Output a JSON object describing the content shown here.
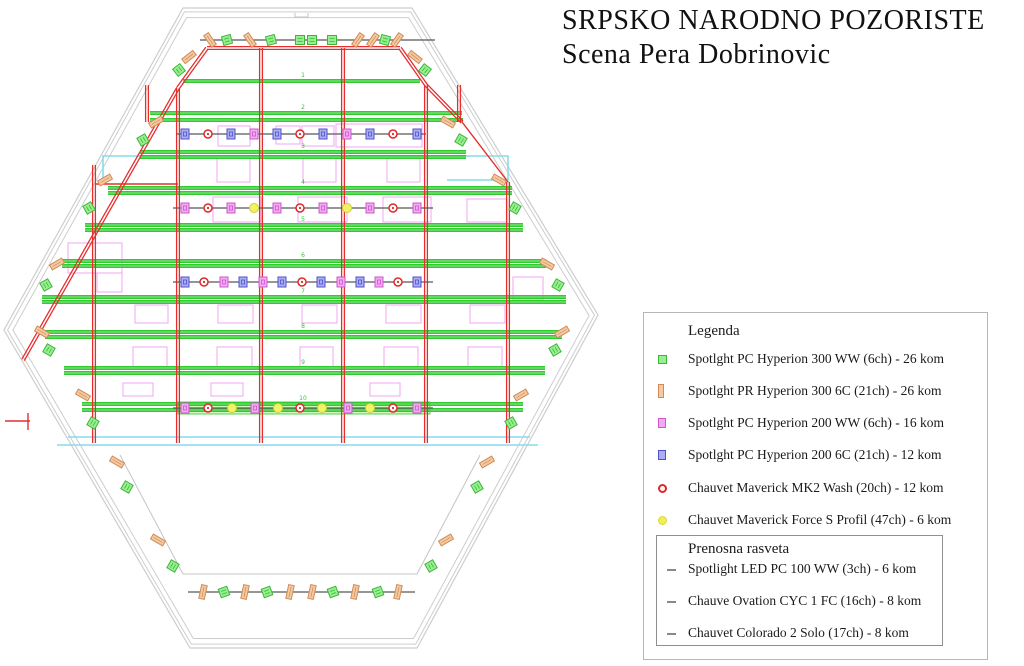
{
  "title": {
    "line1": "SRPSKO NARODNO POZORISTE",
    "line2": "Scena Pera Dobrinovic"
  },
  "legend": {
    "title": "Legenda",
    "items": [
      {
        "icon": "pc-hyperion-300ww-icon",
        "type": "G",
        "label": "Spotlght PC Hyperion 300 WW (6ch) - 26 kom"
      },
      {
        "icon": "pr-hyperion-300-6c-icon",
        "type": "O",
        "label": "Spotlght PR Hyperion 300 6C (21ch) - 26 kom"
      },
      {
        "icon": "pc-hyperion-200ww-icon",
        "type": "M",
        "label": "Spotlght PC Hyperion 200 WW (6ch) - 16 kom"
      },
      {
        "icon": "pc-hyperion-200-6c-icon",
        "type": "B",
        "label": "Spotlght PC Hyperion 200 6C (21ch) - 12 kom"
      },
      {
        "icon": "maverick-mk2-wash-icon",
        "type": "R",
        "label": "Chauvet Maverick MK2 Wash (20ch) - 12 kom"
      },
      {
        "icon": "maverick-force-s-icon",
        "type": "Y",
        "label": "Chauvet Maverick Force S Profil (47ch) - 6 kom"
      }
    ]
  },
  "portable": {
    "title": "Prenosna rasveta",
    "items": [
      {
        "icon": "dash-icon",
        "label": "Spotlight LED PC 100 WW (3ch) - 6 kom"
      },
      {
        "icon": "dash-icon",
        "label": "Chauve Ovation CYC 1 FC (16ch) - 8 kom"
      },
      {
        "icon": "dash-icon",
        "label": "Chauvet Colorado 2 Solo (17ch) - 8 kom"
      }
    ]
  },
  "colors": {
    "outline": "#cdcdcd",
    "floor": "#c4c4c4",
    "bar": "#585858",
    "green": "#2fcb2f",
    "red": "#e62e2e",
    "cyan": "#86dcea",
    "magenta_rect": "#f2a5f0",
    "band_fill": "#d2f7c0",
    "fx": {
      "G": {
        "fill": "#97ef8e",
        "stroke": "#3db53d"
      },
      "O": {
        "fill": "#f3c9a2",
        "stroke": "#d18a55"
      },
      "M": {
        "fill": "#f3aaf3",
        "stroke": "#cb59cb"
      },
      "B": {
        "fill": "#aab0ef",
        "stroke": "#5050cf"
      },
      "R": {
        "fill": "#ffffff",
        "stroke": "#e02828"
      },
      "Y": {
        "fill": "#f2f266",
        "stroke": "#cfcf30"
      }
    }
  },
  "plan": {
    "outer": [
      [
        183,
        8
      ],
      [
        412,
        8
      ],
      [
        598,
        315
      ],
      [
        417,
        648
      ],
      [
        190,
        648
      ],
      [
        4,
        330
      ]
    ],
    "extra_gray": [
      [
        [
          183,
          574
        ],
        [
          417,
          574
        ]
      ],
      [
        [
          183,
          574
        ],
        [
          120,
          455
        ]
      ],
      [
        [
          417,
          574
        ],
        [
          480,
          455
        ]
      ],
      [
        [
          295,
          13
        ],
        [
          295,
          17
        ],
        [
          308,
          17
        ],
        [
          308,
          13
        ]
      ]
    ],
    "cyan": [
      [
        [
          103,
          179
        ],
        [
          103,
          156
        ],
        [
          508,
          156
        ],
        [
          508,
          180
        ],
        [
          447,
          180
        ]
      ],
      [
        [
          68,
          437
        ],
        [
          530,
          437
        ]
      ],
      [
        [
          57,
          445
        ],
        [
          538,
          445
        ]
      ]
    ],
    "battens": [
      [
        81,
        183,
        420
      ],
      [
        113,
        150,
        462
      ],
      [
        120,
        150,
        463
      ],
      [
        152,
        140,
        466
      ],
      [
        157,
        140,
        466
      ],
      [
        188,
        108,
        512
      ],
      [
        193,
        108,
        512
      ],
      [
        225,
        85,
        523
      ],
      [
        230,
        85,
        523
      ],
      [
        261,
        62,
        546
      ],
      [
        266,
        62,
        546
      ],
      [
        297,
        42,
        566
      ],
      [
        302,
        42,
        566
      ],
      [
        332,
        45,
        562
      ],
      [
        337,
        45,
        562
      ],
      [
        368,
        64,
        545
      ],
      [
        373,
        64,
        545
      ],
      [
        404,
        82,
        523
      ],
      [
        410,
        82,
        523
      ]
    ],
    "band": [
      178,
      402,
      252,
      12
    ],
    "red_double": [
      [
        94,
        165,
        94,
        443
      ],
      [
        178,
        88,
        178,
        443
      ],
      [
        261,
        48,
        261,
        443
      ],
      [
        343,
        48,
        343,
        443
      ],
      [
        426,
        85,
        426,
        443
      ],
      [
        508,
        182,
        508,
        443
      ],
      [
        207,
        48,
        400,
        48
      ],
      [
        207,
        48,
        178,
        88
      ],
      [
        400,
        48,
        426,
        85
      ],
      [
        147,
        85,
        147,
        122
      ],
      [
        459,
        85,
        459,
        122
      ],
      [
        178,
        88,
        23,
        360
      ],
      [
        426,
        85,
        462,
        122
      ]
    ],
    "red_single": [
      [
        95,
        184,
        178,
        184
      ],
      [
        5,
        421,
        30,
        421
      ],
      [
        28,
        413,
        28,
        430
      ],
      [
        462,
        122,
        508,
        182
      ]
    ],
    "gray_bars": [
      [
        200,
        40,
        435,
        40
      ],
      [
        176,
        134,
        426,
        134
      ],
      [
        173,
        208,
        433,
        208
      ],
      [
        173,
        282,
        433,
        282
      ],
      [
        173,
        408,
        433,
        408
      ],
      [
        188,
        592,
        415,
        592
      ]
    ],
    "magenta_rects": [
      [
        218,
        126,
        32,
        20
      ],
      [
        276,
        126,
        24,
        18
      ],
      [
        302,
        126,
        32,
        20
      ],
      [
        336,
        124,
        86,
        23
      ],
      [
        217,
        158,
        33,
        24
      ],
      [
        303,
        158,
        33,
        24
      ],
      [
        387,
        158,
        33,
        24
      ],
      [
        213,
        197,
        48,
        25
      ],
      [
        298,
        197,
        49,
        25
      ],
      [
        383,
        197,
        48,
        25
      ],
      [
        467,
        199,
        40,
        23
      ],
      [
        68,
        243,
        54,
        30
      ],
      [
        97,
        273,
        25,
        19
      ],
      [
        513,
        277,
        30,
        23
      ],
      [
        135,
        305,
        33,
        18
      ],
      [
        218,
        305,
        35,
        18
      ],
      [
        302,
        305,
        35,
        18
      ],
      [
        386,
        305,
        35,
        18
      ],
      [
        470,
        305,
        35,
        18
      ],
      [
        133,
        347,
        34,
        20
      ],
      [
        217,
        347,
        35,
        20
      ],
      [
        300,
        347,
        33,
        20
      ],
      [
        384,
        347,
        34,
        20
      ],
      [
        468,
        347,
        34,
        20
      ],
      [
        123,
        383,
        30,
        13
      ],
      [
        211,
        383,
        32,
        13
      ],
      [
        370,
        383,
        30,
        13
      ]
    ],
    "rows": [
      {
        "name": "top-gallery-bar",
        "y": 40,
        "items": [
          [
            210,
            "O",
            -35
          ],
          [
            227,
            "G",
            -15
          ],
          [
            250,
            "O",
            -35
          ],
          [
            271,
            "G",
            -15
          ],
          [
            300,
            "G",
            0
          ],
          [
            312,
            "G",
            0
          ],
          [
            332,
            "G",
            0
          ],
          [
            358,
            "O",
            35
          ],
          [
            373,
            "O",
            35
          ],
          [
            385,
            "G",
            15
          ],
          [
            397,
            "O",
            35
          ]
        ]
      },
      {
        "name": "bar-1",
        "y": 134,
        "items": [
          [
            185,
            "B",
            0
          ],
          [
            208,
            "R",
            0
          ],
          [
            231,
            "B",
            0
          ],
          [
            254,
            "M",
            0
          ],
          [
            277,
            "B",
            0
          ],
          [
            300,
            "R",
            0
          ],
          [
            323,
            "B",
            0
          ],
          [
            347,
            "M",
            0
          ],
          [
            370,
            "B",
            0
          ],
          [
            393,
            "R",
            0
          ],
          [
            417,
            "B",
            0
          ]
        ]
      },
      {
        "name": "bar-2",
        "y": 208,
        "items": [
          [
            185,
            "M",
            0
          ],
          [
            208,
            "R",
            0
          ],
          [
            231,
            "M",
            0
          ],
          [
            254,
            "Y",
            0
          ],
          [
            277,
            "M",
            0
          ],
          [
            300,
            "R",
            0
          ],
          [
            323,
            "M",
            0
          ],
          [
            347,
            "Y",
            0
          ],
          [
            370,
            "M",
            0
          ],
          [
            393,
            "R",
            0
          ],
          [
            417,
            "M",
            0
          ]
        ]
      },
      {
        "name": "bar-3",
        "y": 282,
        "items": [
          [
            185,
            "B",
            0
          ],
          [
            204,
            "R",
            0
          ],
          [
            224,
            "M",
            0
          ],
          [
            243,
            "B",
            0
          ],
          [
            263,
            "M",
            0
          ],
          [
            282,
            "B",
            0
          ],
          [
            302,
            "R",
            0
          ],
          [
            321,
            "B",
            0
          ],
          [
            341,
            "M",
            0
          ],
          [
            360,
            "B",
            0
          ],
          [
            379,
            "M",
            0
          ],
          [
            398,
            "R",
            0
          ],
          [
            417,
            "B",
            0
          ]
        ]
      },
      {
        "name": "bar-4",
        "y": 408,
        "items": [
          [
            185,
            "M",
            0
          ],
          [
            208,
            "R",
            0
          ],
          [
            232,
            "Y",
            0
          ],
          [
            255,
            "M",
            0
          ],
          [
            278,
            "Y",
            0
          ],
          [
            300,
            "R",
            0
          ],
          [
            322,
            "Y",
            0
          ],
          [
            348,
            "M",
            0
          ],
          [
            370,
            "Y",
            0
          ],
          [
            393,
            "R",
            0
          ],
          [
            417,
            "M",
            0
          ]
        ]
      },
      {
        "name": "foh-bar",
        "y": 592,
        "items": [
          [
            203,
            "O",
            12
          ],
          [
            224,
            "G",
            -20
          ],
          [
            245,
            "O",
            12
          ],
          [
            267,
            "G",
            -20
          ],
          [
            290,
            "O",
            12
          ],
          [
            312,
            "O",
            12
          ],
          [
            333,
            "G",
            -20
          ],
          [
            355,
            "O",
            12
          ],
          [
            378,
            "G",
            -20
          ],
          [
            398,
            "O",
            12
          ]
        ]
      }
    ],
    "edge_fixtures": [
      [
        415,
        57,
        "O",
        -52
      ],
      [
        425,
        70,
        "G",
        -52
      ],
      [
        448,
        122,
        "O",
        -60
      ],
      [
        461,
        140,
        "G",
        -60
      ],
      [
        499,
        180,
        "O",
        -60
      ],
      [
        515,
        208,
        "G",
        -60
      ],
      [
        547,
        264,
        "O",
        -60
      ],
      [
        558,
        285,
        "G",
        -60
      ],
      [
        562,
        332,
        "O",
        60
      ],
      [
        555,
        350,
        "G",
        60
      ],
      [
        521,
        395,
        "O",
        60
      ],
      [
        511,
        423,
        "G",
        60
      ],
      [
        487,
        462,
        "O",
        60
      ],
      [
        477,
        487,
        "G",
        60
      ],
      [
        446,
        540,
        "O",
        60
      ],
      [
        431,
        566,
        "G",
        60
      ],
      [
        189,
        57,
        "O",
        52
      ],
      [
        179,
        70,
        "G",
        52
      ],
      [
        156,
        122,
        "O",
        60
      ],
      [
        143,
        140,
        "G",
        60
      ],
      [
        105,
        180,
        "O",
        60
      ],
      [
        89,
        208,
        "G",
        60
      ],
      [
        57,
        264,
        "O",
        60
      ],
      [
        46,
        285,
        "G",
        60
      ],
      [
        42,
        332,
        "O",
        -60
      ],
      [
        49,
        350,
        "G",
        -60
      ],
      [
        83,
        395,
        "O",
        -60
      ],
      [
        93,
        423,
        "G",
        -60
      ],
      [
        117,
        462,
        "O",
        -60
      ],
      [
        127,
        487,
        "G",
        -60
      ],
      [
        158,
        540,
        "O",
        -60
      ],
      [
        173,
        566,
        "G",
        -60
      ]
    ],
    "batten_labels": [
      {
        "n": "1",
        "x": 303,
        "y": 77
      },
      {
        "n": "2",
        "x": 303,
        "y": 109
      },
      {
        "n": "3",
        "x": 303,
        "y": 148
      },
      {
        "n": "4",
        "x": 303,
        "y": 184
      },
      {
        "n": "5",
        "x": 303,
        "y": 221
      },
      {
        "n": "6",
        "x": 303,
        "y": 257
      },
      {
        "n": "7",
        "x": 303,
        "y": 293
      },
      {
        "n": "8",
        "x": 303,
        "y": 328
      },
      {
        "n": "9",
        "x": 303,
        "y": 364
      },
      {
        "n": "10",
        "x": 303,
        "y": 400
      }
    ]
  }
}
